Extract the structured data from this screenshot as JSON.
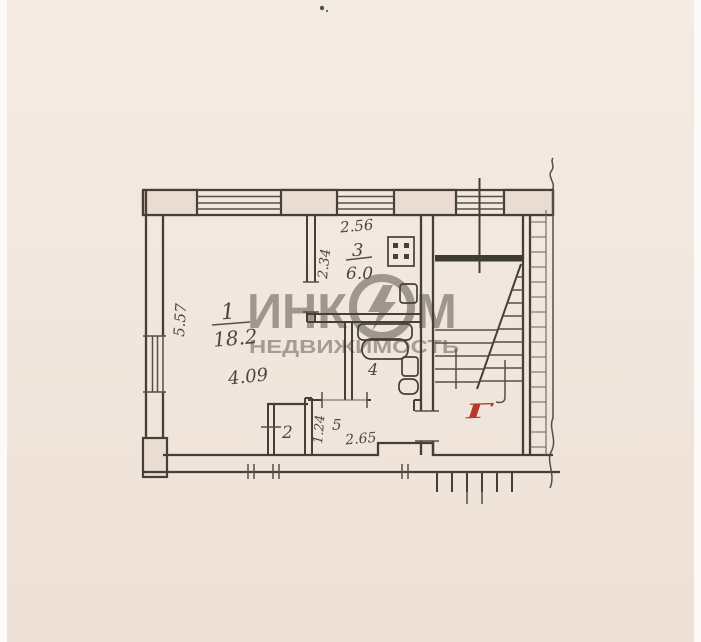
{
  "document": {
    "kind": "apartment floor plan scan",
    "red_mark": "Г"
  },
  "colors": {
    "paper": "#f1e6dd",
    "ink": "#453f38",
    "red_pen": "#b5392c",
    "watermark": "#4e4943"
  },
  "watermark": {
    "brand": "ИНКОМ",
    "brand_prefix": "ИНК",
    "brand_suffix": "М",
    "logo": "lightning-ring-o",
    "subtitle": "НЕДВИЖИМОСТЬ"
  },
  "rooms": {
    "room1": {
      "number": "1",
      "area": "18.2",
      "width_m": "4.09",
      "depth_m": "5.57"
    },
    "room2": {
      "number": "2"
    },
    "room3": {
      "number": "3",
      "area": "6.0",
      "width_m": "2.56",
      "depth_m": "2.34"
    },
    "room4": {
      "number": "4"
    },
    "room5": {
      "number": "5",
      "width_m": "2.65",
      "depth_m": "1.24"
    }
  }
}
